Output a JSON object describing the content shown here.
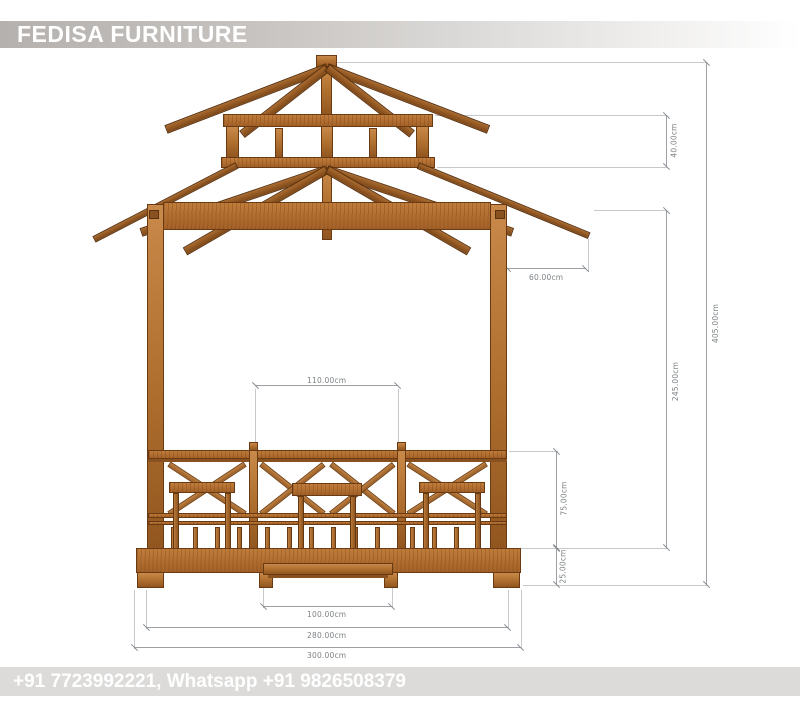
{
  "header": {
    "brand": "FEDISA FURNITURE"
  },
  "footer": {
    "contact": "+91 7723992221, Whatsapp +91 9826508379"
  },
  "dimensions": {
    "clerestory_height": "40.00cm",
    "overall_height": "405.00cm",
    "roof_overhang": "60.00cm",
    "interior_height": "245.00cm",
    "railing_height": "75.00cm",
    "plinth_height": "25.00cm",
    "center_opening_width": "110.00cm",
    "step_width": "100.00cm",
    "post_span_width": "280.00cm",
    "overall_width": "300.00cm"
  },
  "colors": {
    "wood": "#b0702f",
    "wood_dark": "#6a3a12",
    "dimension_line": "#9da1a5",
    "banner_gray": "#c4c0bd",
    "footer_gray": "#dcdbda",
    "text_white": "#ffffff"
  }
}
